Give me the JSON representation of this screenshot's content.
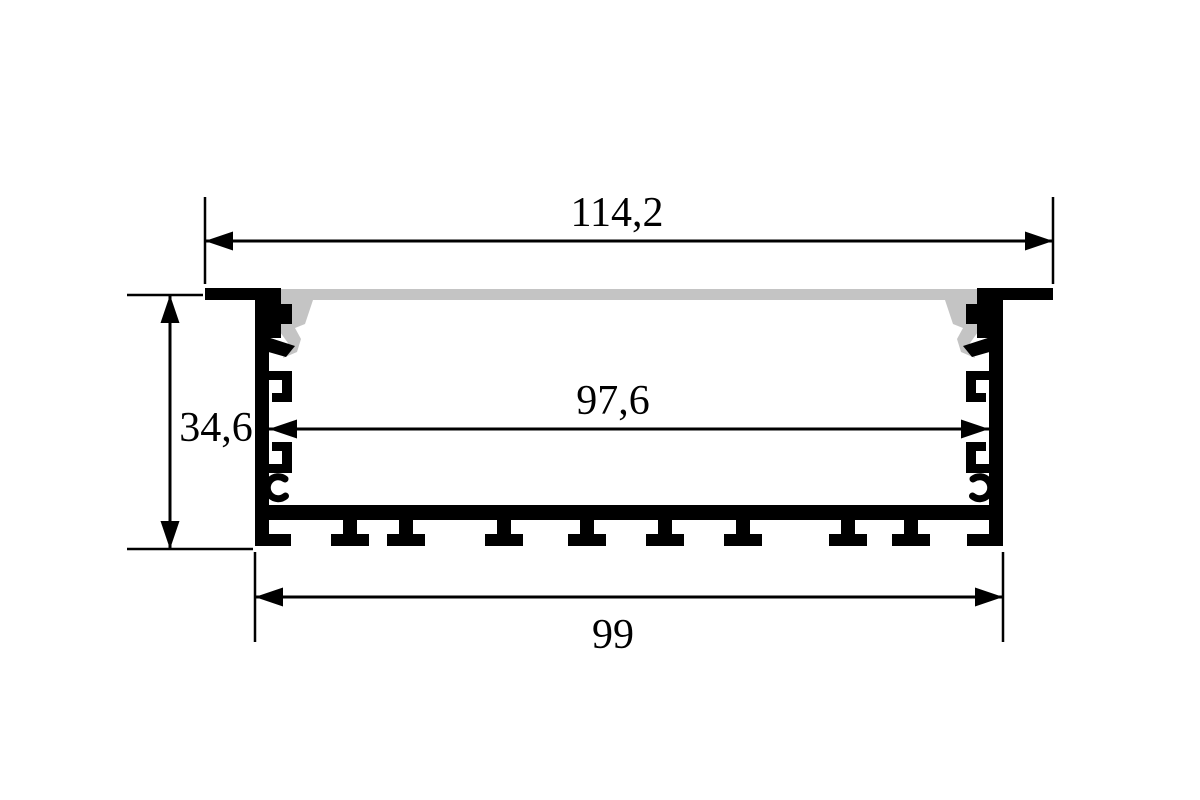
{
  "diagram": {
    "type": "technical-drawing-cross-section",
    "dimensions": {
      "top_width": "114,2",
      "inner_width": "97,6",
      "height": "34,6",
      "bottom_width": "99"
    },
    "colors": {
      "outline": "#000000",
      "diffuser": "#c4c4c4",
      "background": "#ffffff"
    }
  }
}
